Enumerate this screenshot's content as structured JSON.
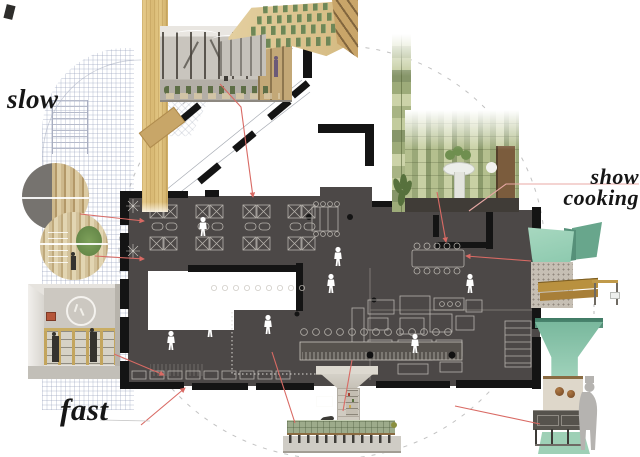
{
  "labels": {
    "slow": "slow",
    "fast": "fast",
    "show_cooking": {
      "line1": "show",
      "line2": "cooking"
    }
  },
  "colors": {
    "background": "#ffffff",
    "label_ink": "#161616",
    "plan_floor": "#4c4847",
    "wall_ink": "#141414",
    "furniture_line": "#c9c5be",
    "leader_red": "#d96a64",
    "leader_pink": "#e8a8a4",
    "dash_gray": "#c2c2c2",
    "grid_line": "#939db9",
    "plank_wood": "#ddbe7c",
    "plank_chip": "#c8a668",
    "mint_light": "#a8d8c0",
    "mint_mid": "#8cc9ae",
    "mint_dark": "#5f947d",
    "hood_green_deep": "#3f7a64",
    "tile_light": "#ccd3a8",
    "tile_mid": "#a8b484",
    "tile_dark": "#87966a",
    "wood_table": "#b9913f",
    "copper_pot": "#6f4423",
    "concrete": "#c6bfb4",
    "silhouette_gray": "#b5b3b0",
    "render_wall": "#c9c5be",
    "timber_dark": "#55504a",
    "plant_green": "#5e6e46"
  }
}
